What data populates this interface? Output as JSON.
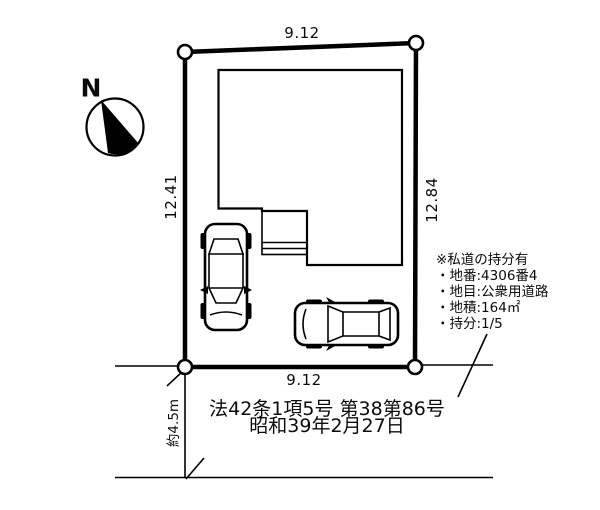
{
  "compass": {
    "north_label": "N"
  },
  "plot": {
    "top_dim": "9.12",
    "bottom_dim": "9.12",
    "left_dim": "12.41",
    "right_dim": "12.84"
  },
  "road": {
    "width_label": "約4.5m"
  },
  "private_road_note": {
    "lines": [
      "※私道の持分有",
      "・地番:4306番4",
      "・地目:公衆用道路",
      "・地積:164㎡",
      "・持分:1/5"
    ]
  },
  "legal": {
    "line1": "法42条1項5号 第38第86号",
    "line2": "昭和39年2月27日"
  },
  "colors": {
    "ink": "#000000",
    "background": "#ffffff"
  }
}
